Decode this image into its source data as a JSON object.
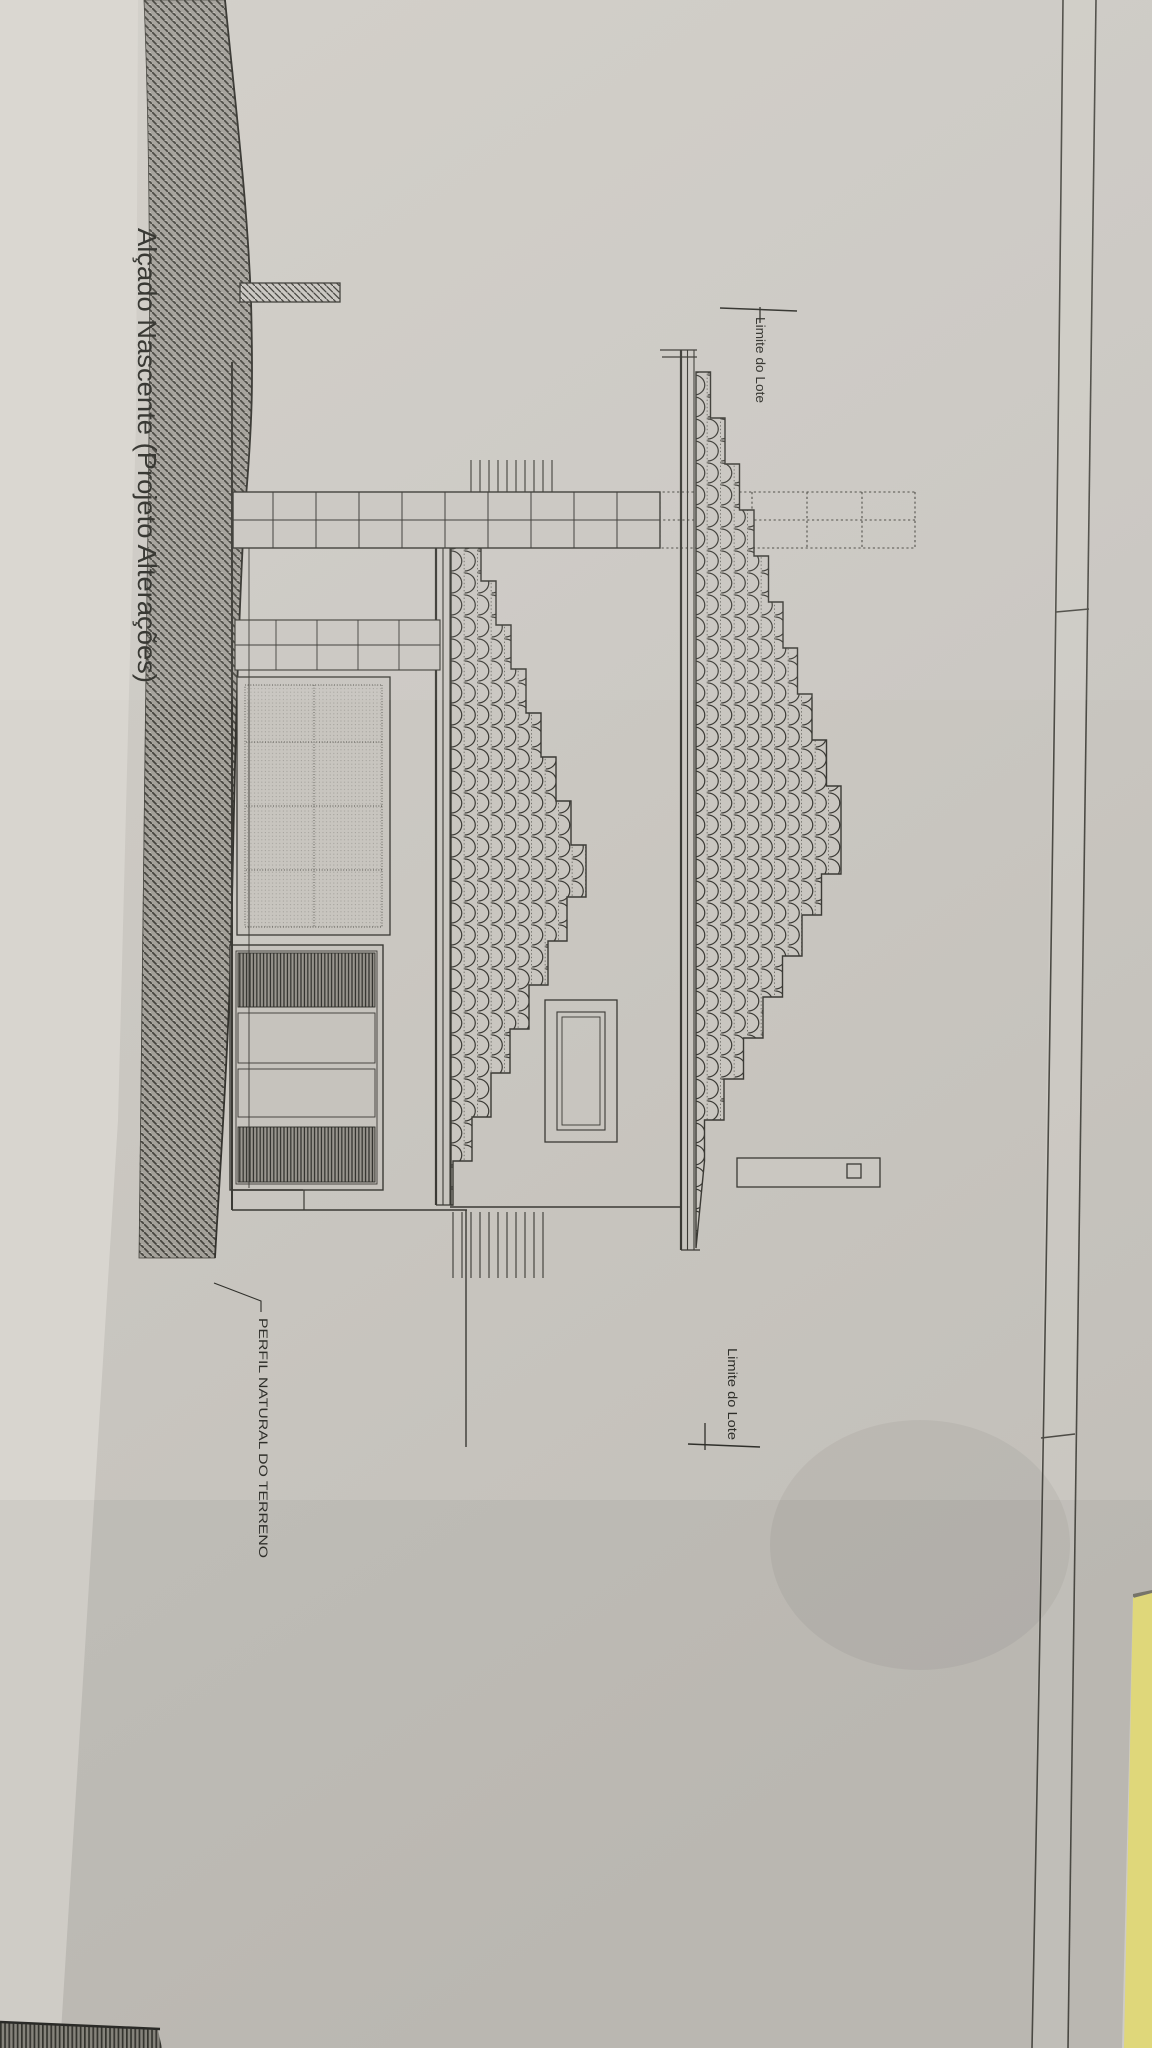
{
  "photo": {
    "sheet": {
      "title": "Alçado Nascente (Projeto Alterações)"
    },
    "labels": {
      "lot_limit_top": "Limite do Lote",
      "lot_limit_bottom": "Limite do Lote",
      "terrain_profile": "PERFIL NATURAL DO TERRENO"
    },
    "colors": {
      "paper": "#cac7c1",
      "background": "#d8d5cf",
      "ink": "#3b3a35",
      "terrain_hatch_base": "#a4a19a",
      "folder_yellow": "#e9e17f"
    }
  }
}
